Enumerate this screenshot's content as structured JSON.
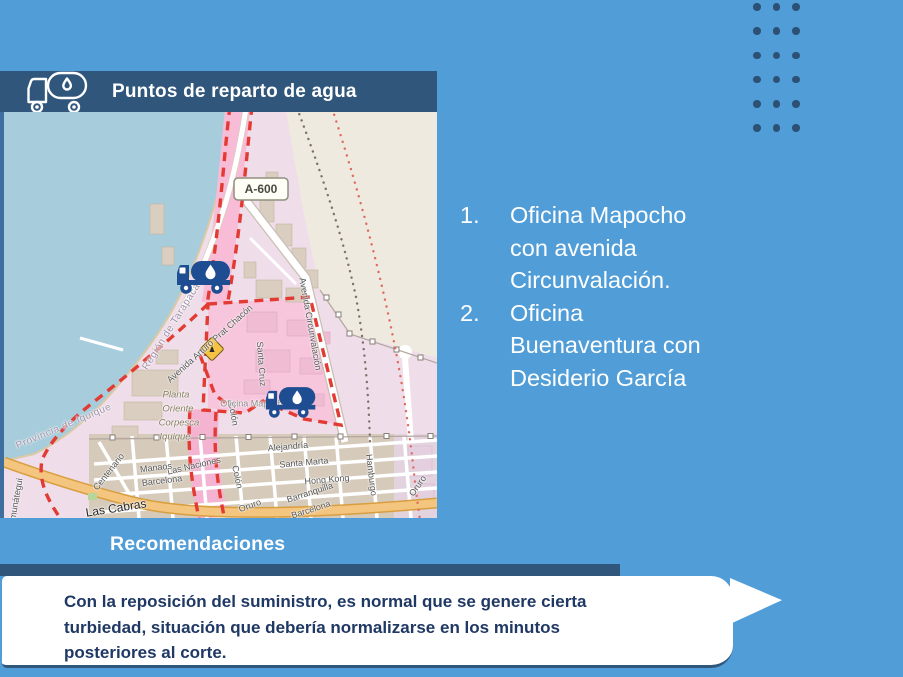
{
  "colors": {
    "background": "#509DD8",
    "panel_dark": "#30567C",
    "marker_navy": "#1F4D91",
    "body_text_navy": "#1F3864",
    "route_red": "#E23B33",
    "map_water": "#A7CDDC",
    "map_sand": "#EFEADF",
    "map_pink_zone": "#F8C6DC"
  },
  "decor": {
    "dots": {
      "rows": 6,
      "cols": 3
    }
  },
  "header": {
    "title": "Puntos de reparto de agua",
    "icon": "water-tank-truck-icon"
  },
  "points": {
    "items": [
      "Oficina Mapocho con avenida Circunvalación.",
      "Oficina Buenaventura con Desiderio García"
    ]
  },
  "recommendations": {
    "title": "Recomendaciones",
    "body": "Con la reposición del suministro, es normal que se genere cierta turbiedad, situación que debería normalizarse en los minutos posteriores al corte."
  },
  "map": {
    "shield": "A-600",
    "markers": [
      "water-truck-marker-north",
      "water-truck-marker-south",
      "hazard-sign"
    ],
    "labels": [
      {
        "t": "Región de Tarapacá",
        "x": 168,
        "y": 215,
        "r": -58,
        "c": "ml-boundary"
      },
      {
        "t": "Provincia de Iquique",
        "x": 60,
        "y": 315,
        "r": -23,
        "c": "ml-boundary"
      },
      {
        "t": "Avenida Arturo Prat Chacón",
        "x": 206,
        "y": 232,
        "r": -42,
        "c": "ml-road"
      },
      {
        "t": "Avenida Circunvalación",
        "x": 306,
        "y": 212,
        "r": 80,
        "c": "ml-road"
      },
      {
        "t": "Santa Cruz",
        "x": 257,
        "y": 252,
        "r": 86,
        "c": "ml-road"
      },
      {
        "t": "Colón",
        "x": 229,
        "y": 302,
        "r": 80,
        "c": "ml-road"
      },
      {
        "t": "Oficina Mapocho",
        "x": 250,
        "y": 292,
        "r": 0,
        "c": "ml-place"
      },
      {
        "t": "Planta",
        "x": 172,
        "y": 283,
        "r": 0,
        "c": "ml-plant"
      },
      {
        "t": "Oriente",
        "x": 174,
        "y": 297,
        "r": 0,
        "c": "ml-plant"
      },
      {
        "t": "Corpesca",
        "x": 175,
        "y": 311,
        "r": 0,
        "c": "ml-plant"
      },
      {
        "t": "Iquique",
        "x": 171,
        "y": 325,
        "r": 0,
        "c": "ml-plant"
      },
      {
        "t": "Alejandría",
        "x": 284,
        "y": 335,
        "r": -5,
        "c": "ml-road"
      },
      {
        "t": "Santa Marta",
        "x": 300,
        "y": 351,
        "r": -5,
        "c": "ml-road"
      },
      {
        "t": "Hong Kong",
        "x": 323,
        "y": 368,
        "r": -5,
        "c": "ml-road"
      },
      {
        "t": "Barranquilla",
        "x": 306,
        "y": 381,
        "r": -18,
        "c": "ml-road"
      },
      {
        "t": "Barcelona",
        "x": 307,
        "y": 398,
        "r": -18,
        "c": "ml-road"
      },
      {
        "t": "Las Naciones",
        "x": 190,
        "y": 354,
        "r": -13,
        "c": "ml-road"
      },
      {
        "t": "Manaos",
        "x": 152,
        "y": 356,
        "r": -7,
        "c": "ml-road"
      },
      {
        "t": "Barcelona",
        "x": 158,
        "y": 369,
        "r": -7,
        "c": "ml-road"
      },
      {
        "t": "Colón",
        "x": 233,
        "y": 365,
        "r": 78,
        "c": "ml-road"
      },
      {
        "t": "Oruro",
        "x": 246,
        "y": 394,
        "r": -20,
        "c": "ml-road"
      },
      {
        "t": "Hamburgo",
        "x": 367,
        "y": 363,
        "r": 83,
        "c": "ml-road"
      },
      {
        "t": "Oruro",
        "x": 414,
        "y": 374,
        "r": -55,
        "c": "ml-road"
      },
      {
        "t": "Centenario",
        "x": 105,
        "y": 360,
        "r": -52,
        "c": "ml-road"
      },
      {
        "t": "Las Cabras",
        "x": 112,
        "y": 396,
        "r": -9,
        "c": "ml-major"
      },
      {
        "t": "Amunátegui",
        "x": 12,
        "y": 390,
        "r": -80,
        "c": "ml-road"
      }
    ]
  }
}
